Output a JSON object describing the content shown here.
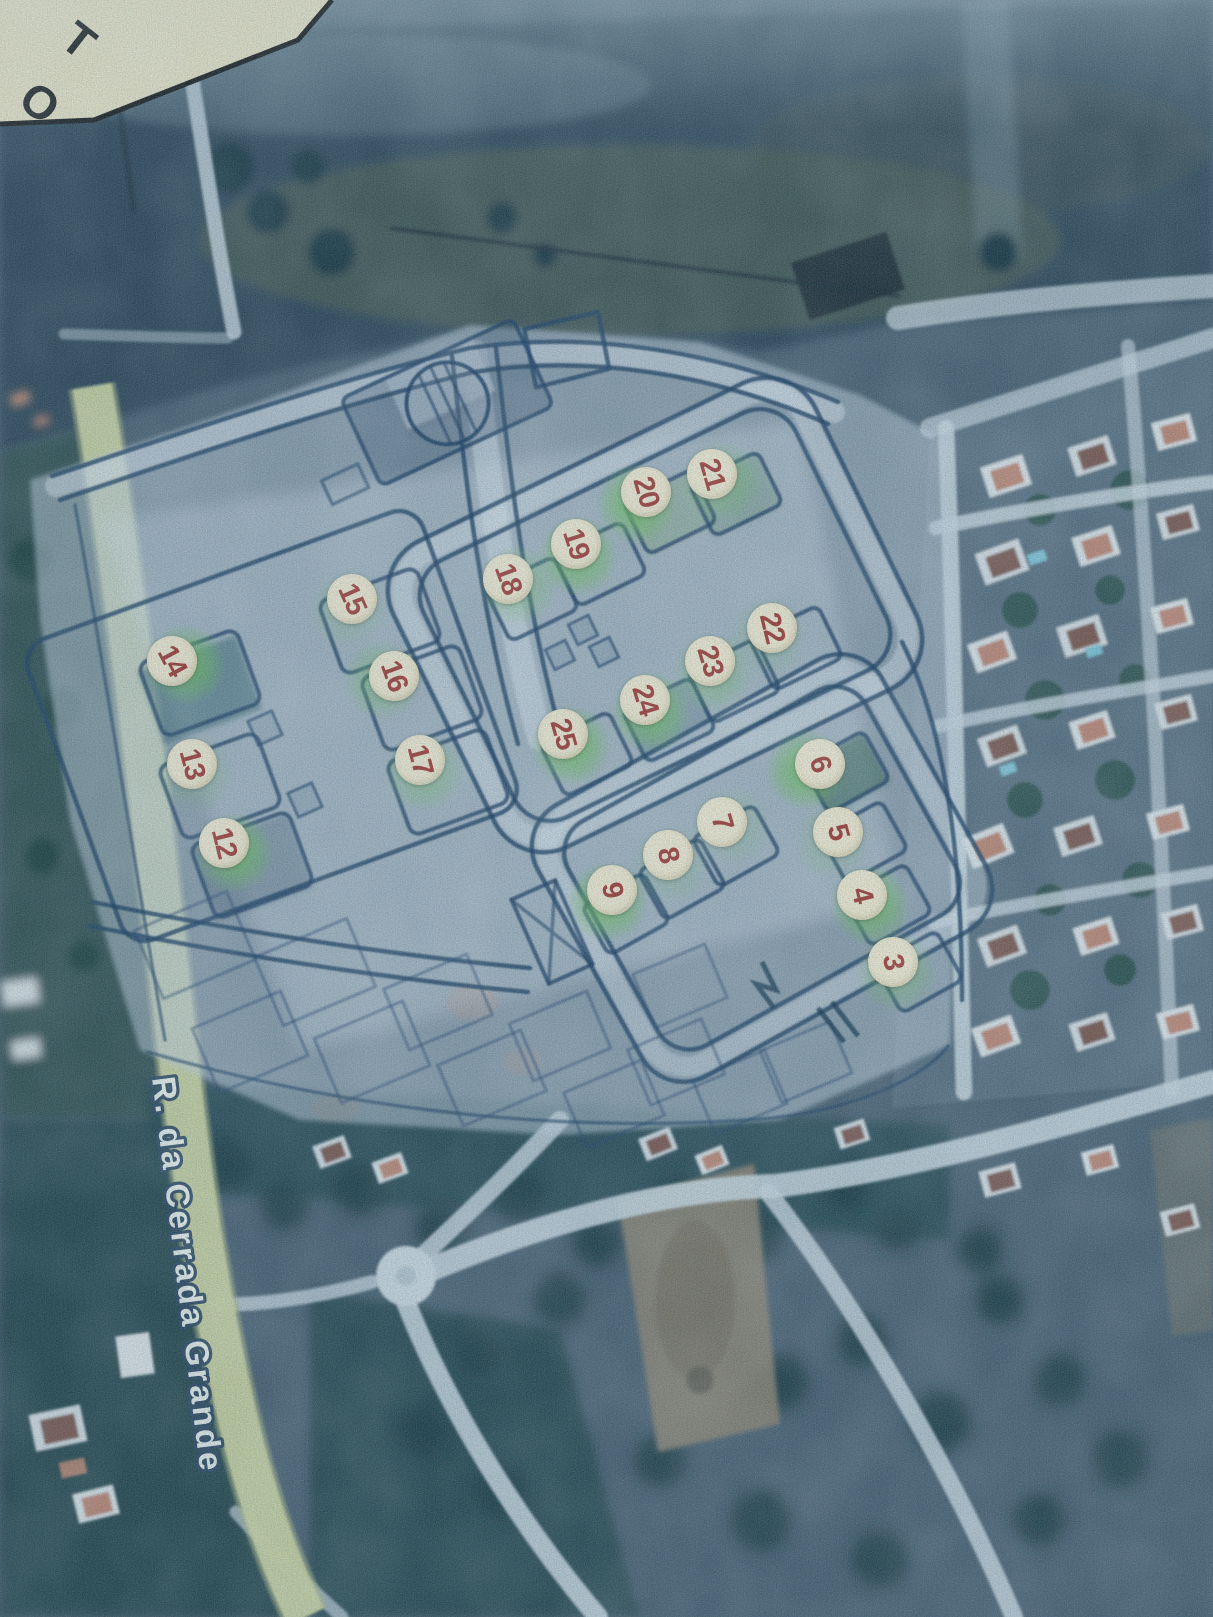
{
  "street_label": {
    "text": "R. da Cerrada Grande"
  },
  "corner_callout": {
    "fragments": [
      "T",
      "O"
    ]
  },
  "markers": [
    {
      "number": "3",
      "x": 893,
      "y": 962,
      "rot": 79,
      "glow": "mild",
      "gdx": 4,
      "gdy": 10
    },
    {
      "number": "4",
      "x": 862,
      "y": 895,
      "rot": 76,
      "glow": "strong",
      "gdx": 8,
      "gdy": 10
    },
    {
      "number": "5",
      "x": 838,
      "y": 832,
      "rot": 74,
      "glow": "faint",
      "gdx": -6,
      "gdy": 8
    },
    {
      "number": "6",
      "x": 820,
      "y": 764,
      "rot": 72,
      "glow": "strong",
      "gdx": -14,
      "gdy": 6
    },
    {
      "number": "7",
      "x": 722,
      "y": 822,
      "rot": 74,
      "glow": "faint",
      "gdx": 10,
      "gdy": 4
    },
    {
      "number": "8",
      "x": 668,
      "y": 855,
      "rot": 77,
      "glow": "faint",
      "gdx": 2,
      "gdy": 10
    },
    {
      "number": "9",
      "x": 612,
      "y": 890,
      "rot": 79,
      "glow": "strong",
      "gdx": -4,
      "gdy": 12
    },
    {
      "number": "12",
      "x": 224,
      "y": 843,
      "rot": 76,
      "glow": "strong",
      "gdx": 10,
      "gdy": 10
    },
    {
      "number": "13",
      "x": 192,
      "y": 764,
      "rot": 75,
      "glow": "faint",
      "gdx": 2,
      "gdy": 10
    },
    {
      "number": "14",
      "x": 172,
      "y": 661,
      "rot": 62,
      "glow": "strong",
      "gdx": 14,
      "gdy": 4
    },
    {
      "number": "15",
      "x": 352,
      "y": 599,
      "rot": 66,
      "glow": "faint",
      "gdx": -4,
      "gdy": 10
    },
    {
      "number": "16",
      "x": 394,
      "y": 676,
      "rot": 70,
      "glow": "mild",
      "gdx": -12,
      "gdy": 4
    },
    {
      "number": "17",
      "x": 420,
      "y": 760,
      "rot": 75,
      "glow": "mild",
      "gdx": 4,
      "gdy": 12
    },
    {
      "number": "18",
      "x": 508,
      "y": 579,
      "rot": 70,
      "glow": "mild",
      "gdx": 10,
      "gdy": 6
    },
    {
      "number": "19",
      "x": 576,
      "y": 544,
      "rot": 72,
      "glow": "strong",
      "gdx": 2,
      "gdy": 12
    },
    {
      "number": "20",
      "x": 646,
      "y": 492,
      "rot": 74,
      "glow": "strong",
      "gdx": -10,
      "gdy": 12
    },
    {
      "number": "21",
      "x": 712,
      "y": 474,
      "rot": 74,
      "glow": "mild",
      "gdx": 10,
      "gdy": 6
    },
    {
      "number": "22",
      "x": 772,
      "y": 628,
      "rot": 76,
      "glow": "faint",
      "gdx": -4,
      "gdy": 10
    },
    {
      "number": "23",
      "x": 710,
      "y": 661,
      "rot": 73,
      "glow": "mild",
      "gdx": 2,
      "gdy": 12
    },
    {
      "number": "24",
      "x": 645,
      "y": 700,
      "rot": 73,
      "glow": "strong",
      "gdx": 6,
      "gdy": 12
    },
    {
      "number": "25",
      "x": 563,
      "y": 734,
      "rot": 74,
      "glow": "strong",
      "gdx": 8,
      "gdy": 12
    }
  ],
  "colors": {
    "marker_fill": "#f4ebd1",
    "marker_number": "#a23a33",
    "marker_glow": "#70c05c",
    "plan_ink": "#1f3f63",
    "road_highlight_yellow": "#ced5a2",
    "street_label_fill": "#f3f6f1",
    "street_label_outline": "#2c4660",
    "callout_fill": "#f2e9c8",
    "aerial_base": "#46596a"
  }
}
